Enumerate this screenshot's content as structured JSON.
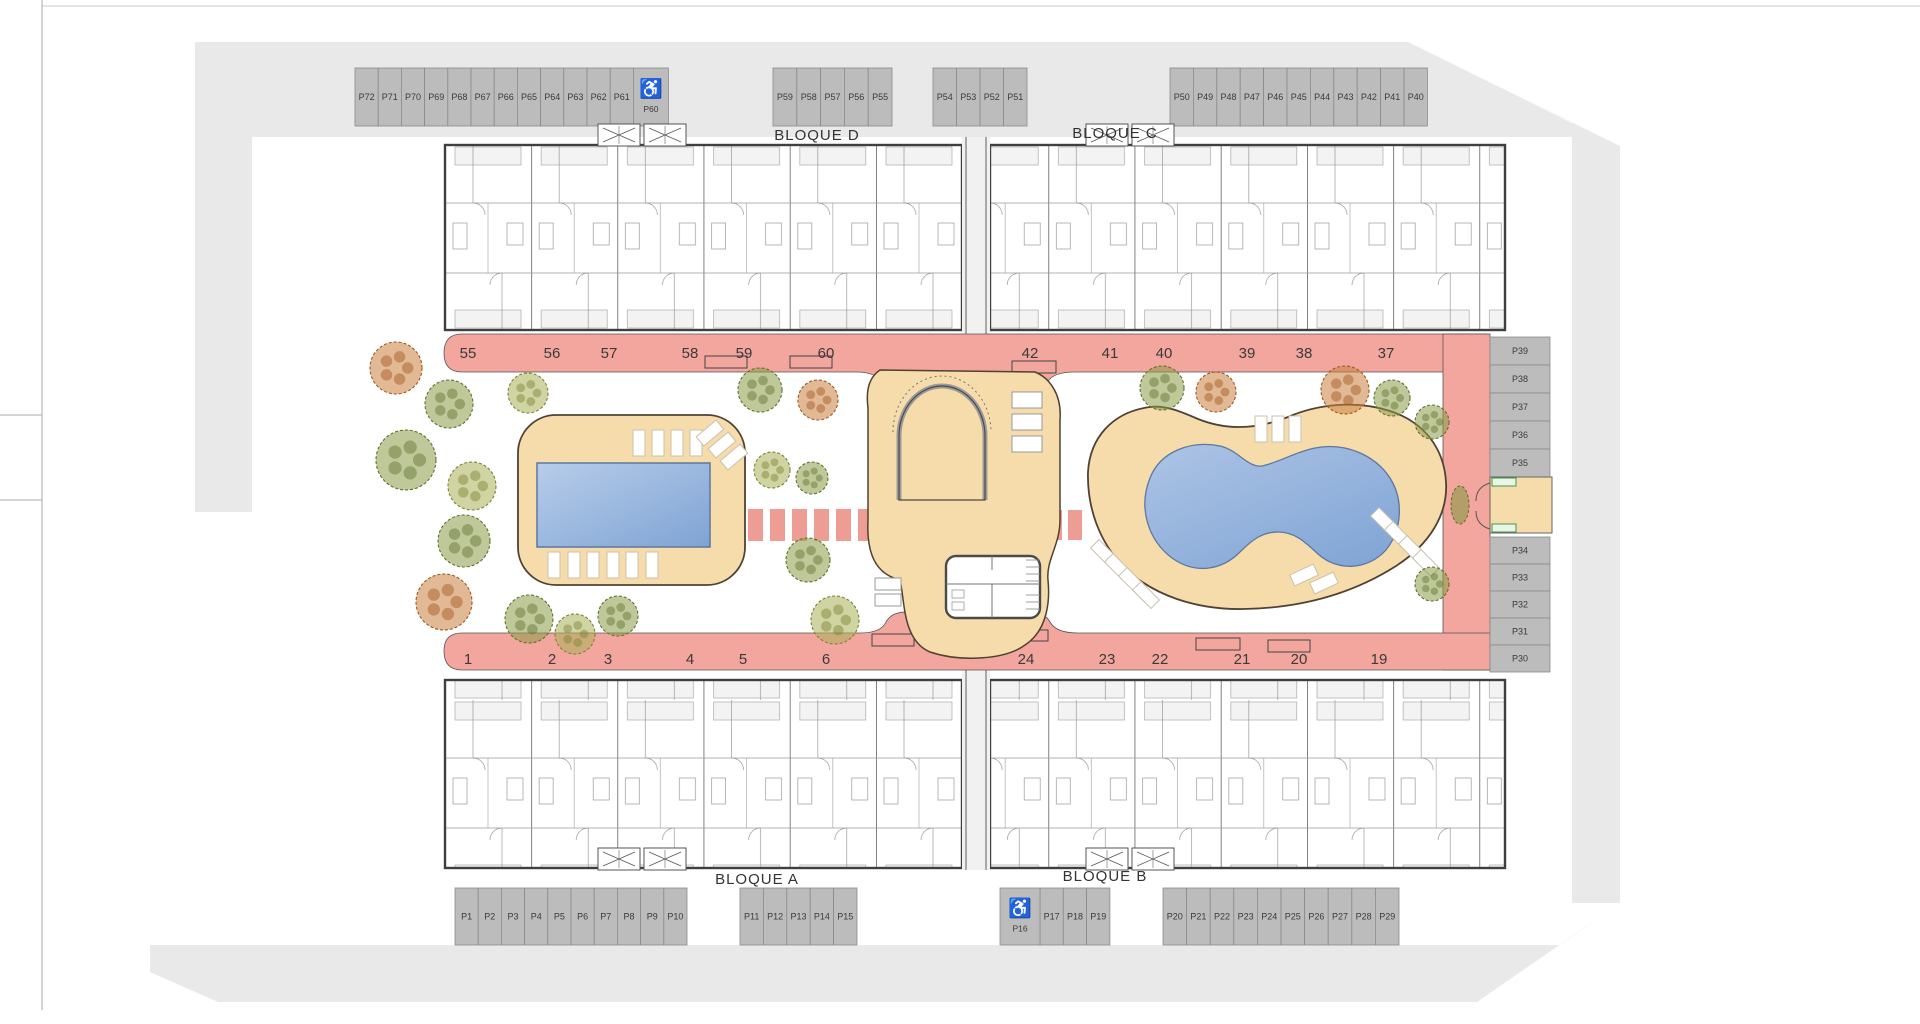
{
  "plan": {
    "blocks": {
      "a": "BLOQUE A",
      "b": "BLOQUE B",
      "c": "BLOQUE C",
      "d": "BLOQUE D"
    },
    "parking_groups": {
      "top_left": [
        "P72",
        "P71",
        "P70",
        "P69",
        "P68",
        "P67",
        "P66",
        "P65",
        "P64",
        "P63",
        "P62",
        "P61"
      ],
      "top_left_handicap": "P60",
      "top_mid_a": [
        "P59",
        "P58",
        "P57",
        "P56",
        "P55"
      ],
      "top_mid_b": [
        "P54",
        "P53",
        "P52",
        "P51"
      ],
      "top_right": [
        "P50",
        "P49",
        "P48",
        "P47",
        "P46",
        "P45",
        "P44",
        "P43",
        "P42",
        "P41",
        "P40"
      ],
      "right_upper": [
        "P39",
        "P38",
        "P37",
        "P36",
        "P35"
      ],
      "right_lower": [
        "P34",
        "P33",
        "P32",
        "P31",
        "P30"
      ],
      "bottom_left": [
        "P1",
        "P2",
        "P3",
        "P4",
        "P5",
        "P6",
        "P7",
        "P8",
        "P9",
        "P10"
      ],
      "bottom_mid_a": [
        "P11",
        "P12",
        "P13",
        "P14",
        "P15"
      ],
      "bottom_handicap": "P16",
      "bottom_mid_b": [
        "P17",
        "P18",
        "P19"
      ],
      "bottom_right": [
        "P20",
        "P21",
        "P22",
        "P23",
        "P24",
        "P25",
        "P26",
        "P27",
        "P28",
        "P29"
      ]
    },
    "walkway_numbers": {
      "top_left": [
        "55",
        "56",
        "57",
        "58",
        "59",
        "60"
      ],
      "top_right": [
        "42",
        "41",
        "40",
        "39",
        "38",
        "37"
      ],
      "bottom_left": [
        "1",
        "2",
        "3",
        "4",
        "5",
        "6"
      ],
      "bottom_right": [
        "24",
        "23",
        "22",
        "21",
        "20",
        "19"
      ]
    },
    "handicap_symbol": "♿",
    "colors": {
      "road": "#e9e9e9",
      "stall": "#bcbcbc",
      "stall_line": "#8a8a8a",
      "walkway": "#f2a69e",
      "stone": "#ee9d95",
      "deck": "#f6dcab",
      "deck_edge": "#4f4134",
      "pool_light": "#b7cdea",
      "pool_dark": "#7fa3d4",
      "pool_edge": "#5d77a0",
      "wall": "#474747",
      "inner_wall": "#9a9a9a",
      "label_text": "#3a3a3a",
      "tree_olive": "#8a9a45",
      "tree_olive_dark": "#5f7030",
      "tree_light": "#aab055",
      "tree_light_dark": "#7c8236",
      "tree_orange": "#c87f3e",
      "tree_orange_dark": "#a3561f",
      "entrance_green": "#3f9b3f"
    }
  }
}
